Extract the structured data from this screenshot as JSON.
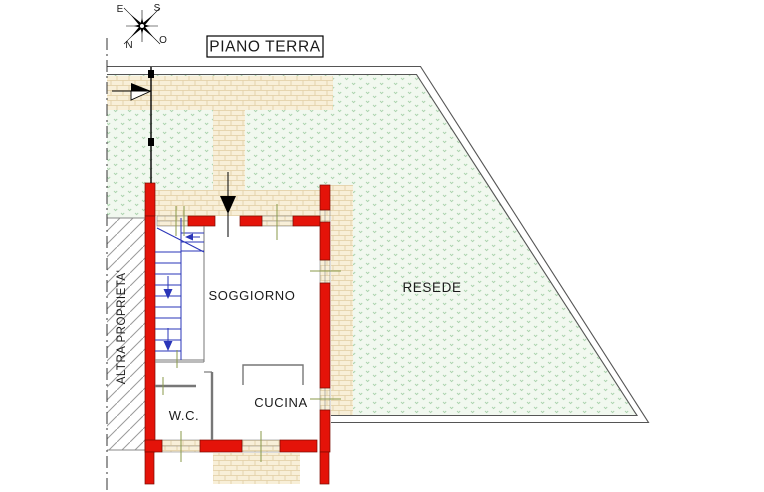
{
  "header": {
    "title": "PIANO TERRA",
    "compass": {
      "east": "E",
      "south": "S",
      "north": "N",
      "west": "O"
    }
  },
  "plan": {
    "rooms": {
      "living": "SOGGIORNO",
      "kitchen": "CUCINA",
      "wc": "W.C."
    },
    "outdoor": {
      "yard": "RESEDE",
      "neighbor": "ALTRA PROPRIETA'"
    }
  },
  "colors": {
    "wall_red": "#e41309",
    "wall_edge": "#7a0b00",
    "brick_bg": "#f8efd8",
    "brick_line": "#e0cda2",
    "grass_bg": "#f1f8ef",
    "grass_mark": "#a9d2ac",
    "stair_blue": "#2a35b8",
    "tick_green": "#8a9a4a",
    "boundary_gray": "#555555",
    "partition_gray": "#777777"
  }
}
